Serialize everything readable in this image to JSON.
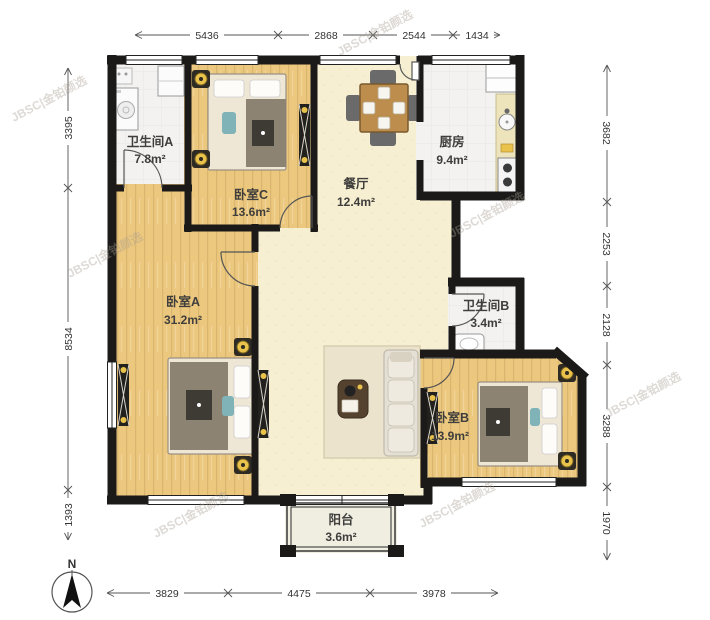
{
  "watermark": {
    "text": "JBSC|金铂颜选"
  },
  "compass": {
    "label": "N"
  },
  "rooms": {
    "bathroom_a": {
      "name": "卫生间A",
      "area": "7.8m²"
    },
    "bedroom_c": {
      "name": "卧室C",
      "area": "13.6m²"
    },
    "dining": {
      "name": "餐厅",
      "area": "12.4m²"
    },
    "kitchen": {
      "name": "厨房",
      "area": "9.4m²"
    },
    "bedroom_a": {
      "name": "卧室A",
      "area": "31.2m²"
    },
    "bathroom_b": {
      "name": "卫生间B",
      "area": "3.4m²"
    },
    "bedroom_b": {
      "name": "卧室B",
      "area": "13.9m²"
    },
    "balcony": {
      "name": "阳台",
      "area": "3.6m²"
    }
  },
  "dimensions": {
    "top": [
      "5436",
      "2868",
      "2544",
      "1434"
    ],
    "bottom": [
      "3829",
      "4475",
      "3978"
    ],
    "left": [
      "3395",
      "8534",
      "1393"
    ],
    "right": [
      "3682",
      "2253",
      "2128",
      "3288",
      "1970"
    ]
  },
  "colors": {
    "wall": "#1b1a18",
    "wood_floor": "#ecc87e",
    "living_floor": "#f6efd2",
    "tile_floor": "#f3f2f0",
    "balcony_floor": "#f0eee1",
    "accent_yellow": "#e9c24b",
    "dim_text": "#333333"
  }
}
